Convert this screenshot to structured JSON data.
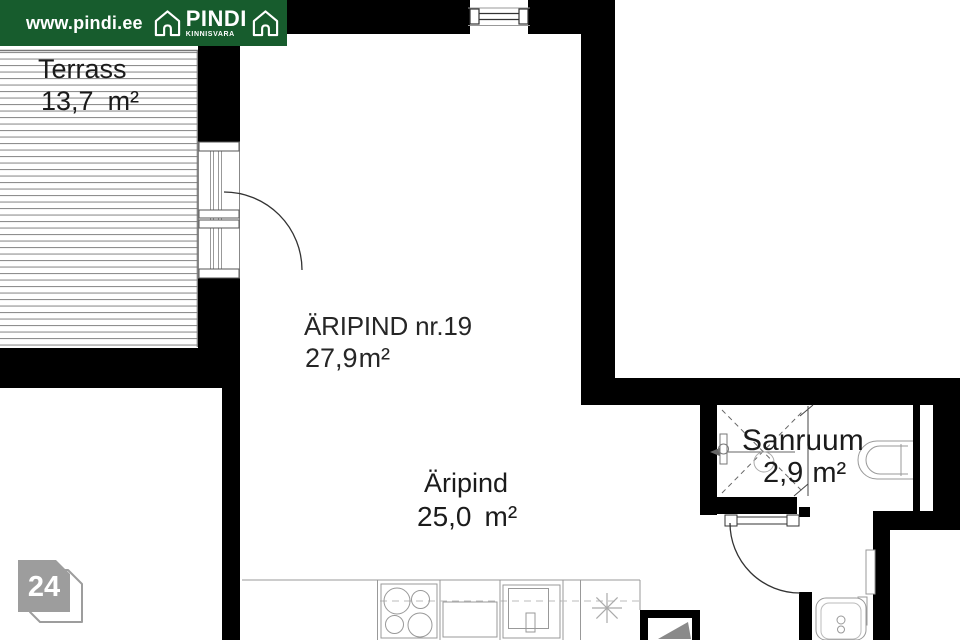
{
  "header": {
    "url_text": "www.pindi.ee",
    "brand_name": "PINDI",
    "brand_subtitle": "KINNISVARA"
  },
  "rooms": {
    "terrass": {
      "name": "Terrass",
      "area_value": "13,7",
      "area_unit": "m²"
    },
    "unit_label": {
      "name": "ÄRIPIND nr.19",
      "area_value": "27,9",
      "area_unit": "m²"
    },
    "aripind": {
      "name": "Äripind",
      "area_value": "25,0",
      "area_unit": "m²"
    },
    "sanruum": {
      "name": "Sanruum",
      "area_value": "2,9",
      "area_unit": "m²"
    }
  },
  "page_badge": {
    "number": "24"
  },
  "colors": {
    "brand_green": "#175C2D",
    "wall_black": "#000000",
    "badge_gray": "#9d9d9d",
    "fixture_line_gray": "#999999"
  }
}
